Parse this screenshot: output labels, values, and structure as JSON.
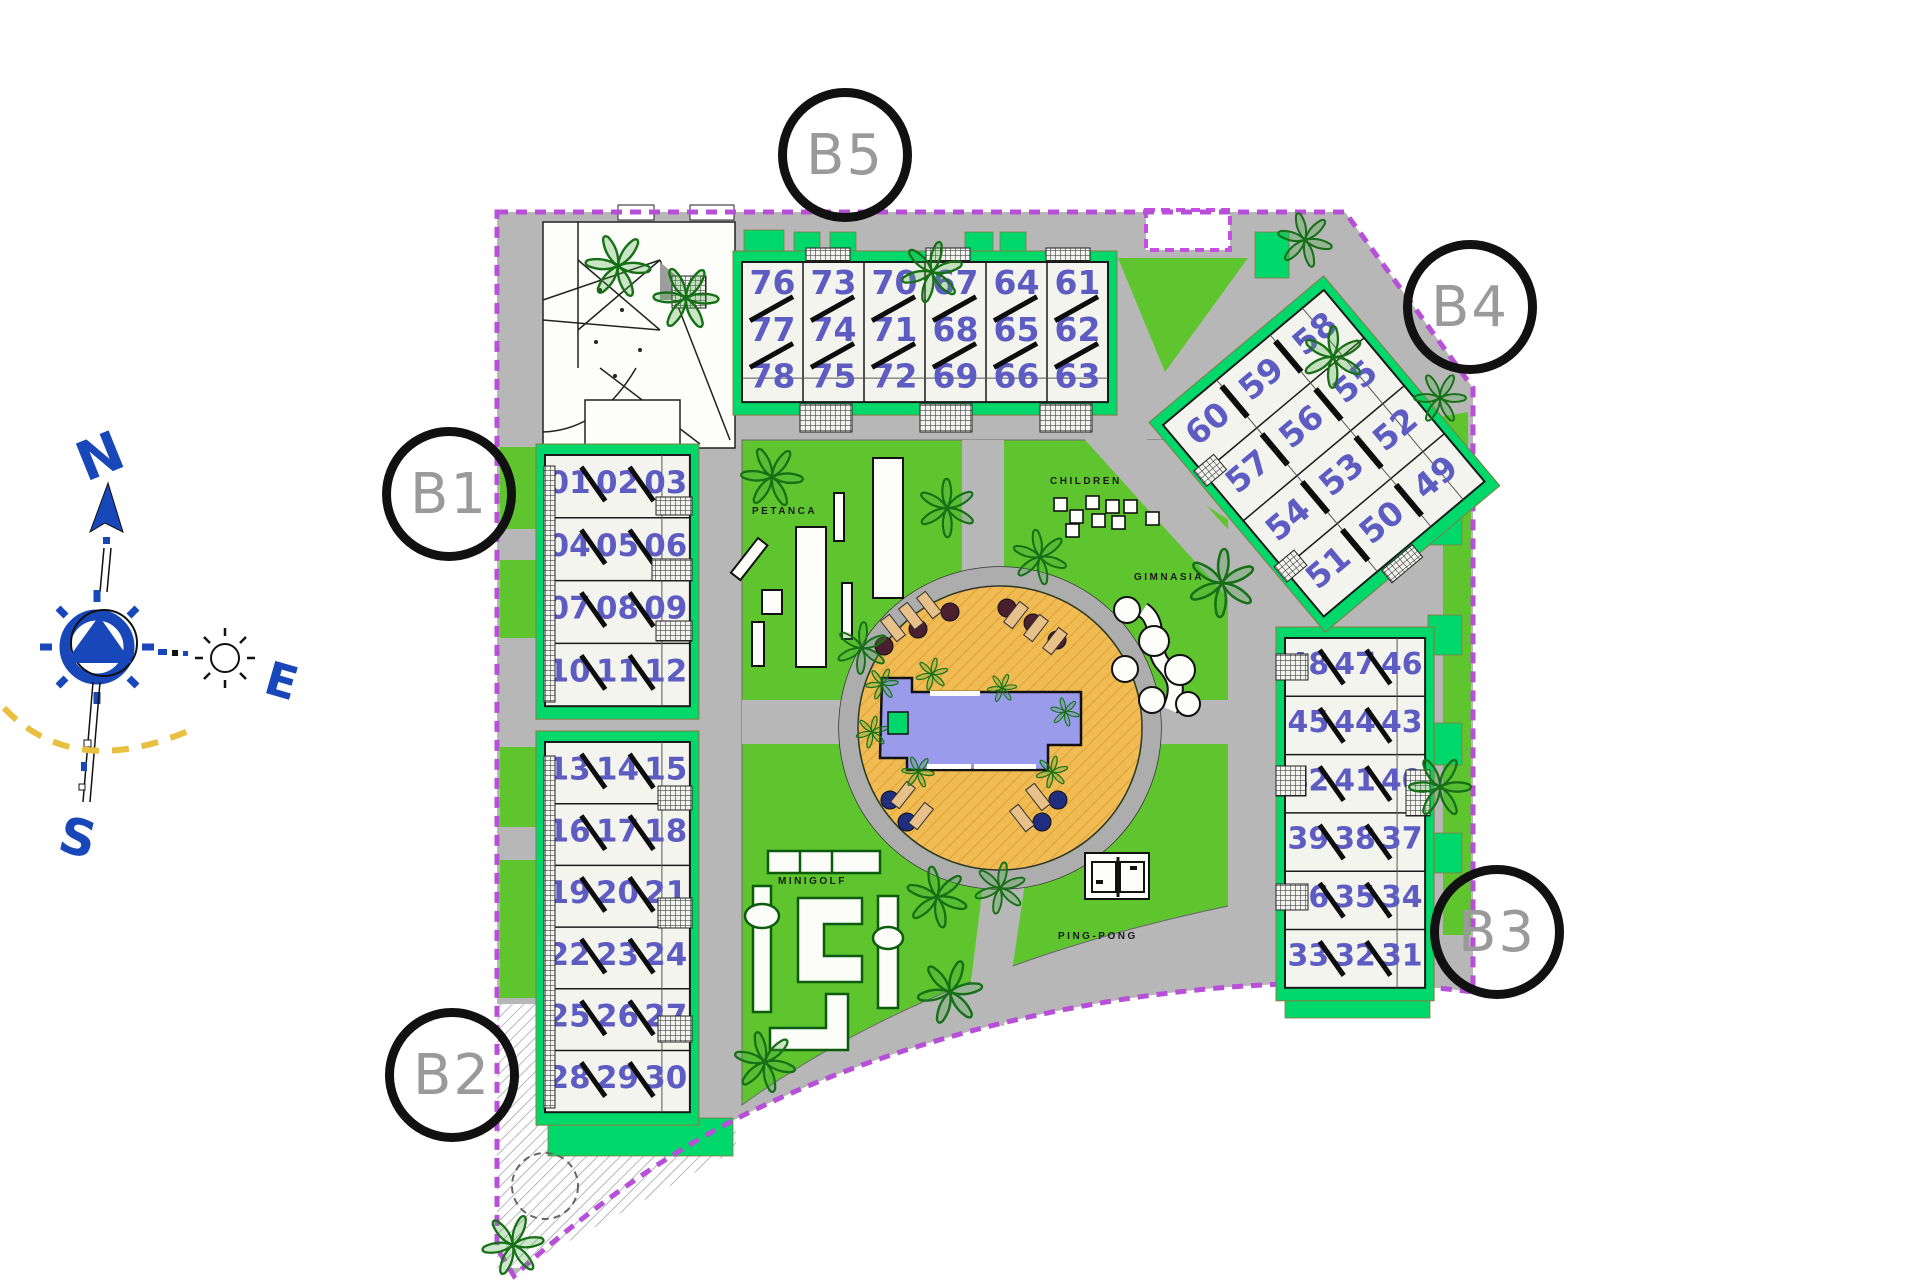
{
  "plan": {
    "title": "residential-site-plan",
    "compass": {
      "north": "N",
      "east": "E",
      "south": "S"
    },
    "block_circles": [
      {
        "label": "B1"
      },
      {
        "label": "B2"
      },
      {
        "label": "B3"
      },
      {
        "label": "B4"
      },
      {
        "label": "B5"
      }
    ],
    "amenity_labels": {
      "petanca": "PETANCA",
      "children": "CHILDREN",
      "gimnasia": "GIMNASIA",
      "minigolf": "MINIGOLF",
      "pingpong": "PING-PONG"
    },
    "blocks": [
      {
        "id": "B5",
        "rows": [
          [
            "76",
            "73",
            "70",
            "67",
            "64",
            "61"
          ],
          [
            "77",
            "74",
            "71",
            "68",
            "65",
            "62"
          ],
          [
            "78",
            "75",
            "72",
            "69",
            "66",
            "63"
          ]
        ]
      },
      {
        "id": "B1",
        "rows": [
          [
            "01",
            "02",
            "03"
          ],
          [
            "04",
            "05",
            "06"
          ],
          [
            "07",
            "08",
            "09"
          ],
          [
            "10",
            "11",
            "12"
          ]
        ]
      },
      {
        "id": "B2",
        "rows": [
          [
            "13",
            "14",
            "15"
          ],
          [
            "16",
            "17",
            "18"
          ],
          [
            "19",
            "20",
            "21"
          ],
          [
            "22",
            "23",
            "24"
          ],
          [
            "25",
            "26",
            "27"
          ],
          [
            "28",
            "29",
            "30"
          ]
        ]
      },
      {
        "id": "B3",
        "rows": [
          [
            "48",
            "47",
            "46"
          ],
          [
            "45",
            "44",
            "43"
          ],
          [
            "42",
            "41",
            "40"
          ],
          [
            "39",
            "38",
            "37"
          ],
          [
            "36",
            "35",
            "34"
          ],
          [
            "33",
            "32",
            "31"
          ]
        ]
      },
      {
        "id": "B4",
        "rows": [
          [
            "60",
            "59",
            "58"
          ],
          [
            "57",
            "56",
            "55"
          ],
          [
            "54",
            "53",
            "52"
          ],
          [
            "51",
            "50",
            "49"
          ]
        ]
      }
    ],
    "colors": {
      "boundary": "#b84fd8",
      "road": "#b7b7b7",
      "lawn": "#5fc52f",
      "emerald": "#00d86b",
      "building": "#f4f4ee",
      "unit_number": "#5c5cc2",
      "pool_deck": "#f0bb52",
      "pool_water": "#9b9bec",
      "compass_blue": "#1747b8",
      "sun_path_yellow": "#e8bf3e"
    },
    "icons": [
      "tree-icon",
      "sun-icon",
      "compass-rose-icon",
      "ping-pong-table-icon",
      "pool-icon",
      "sun-lounger-icon",
      "umbrella-icon",
      "stairs-icon",
      "roundabout-icon"
    ]
  }
}
